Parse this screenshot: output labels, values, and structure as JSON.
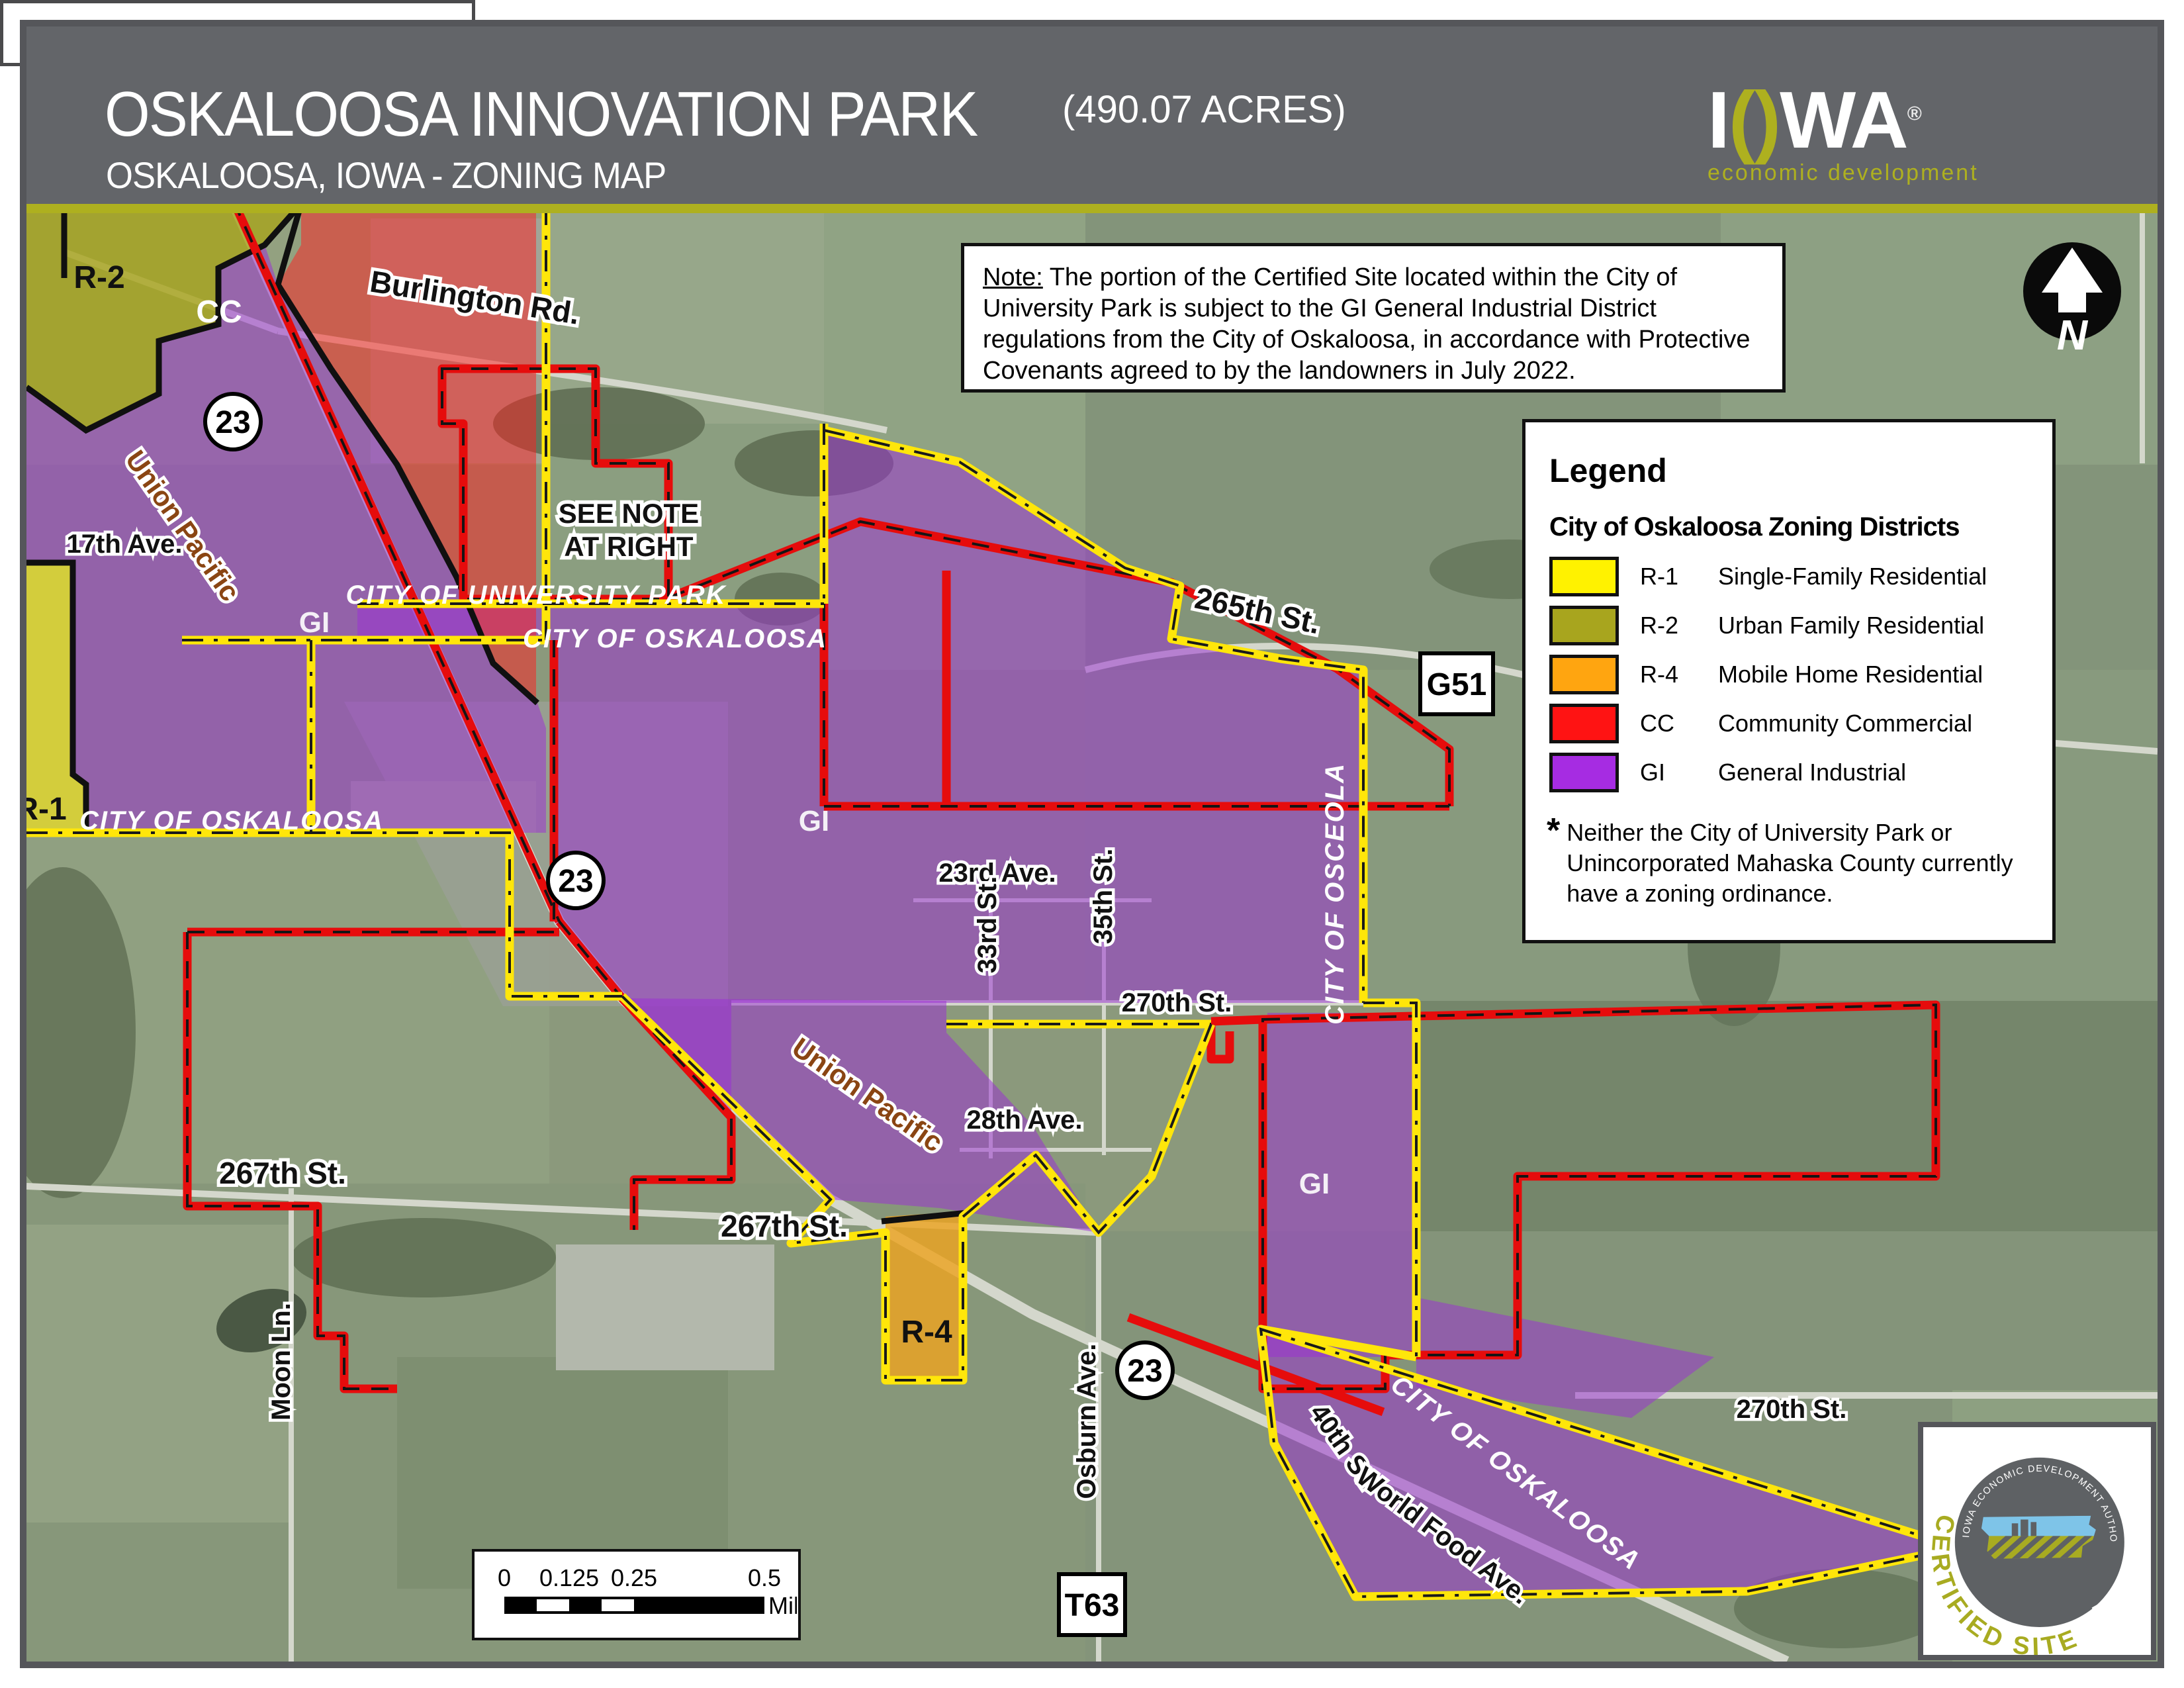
{
  "header": {
    "title": "OSKALOOSA INNOVATION PARK",
    "acres": "(490.07 ACRES)",
    "subtitle": "OSKALOOSA, IOWA - ZONING MAP",
    "logo": {
      "i": "I",
      "o": "()",
      "wa": "WA",
      "reg": "®",
      "tagline": "economic development"
    }
  },
  "note": {
    "label": "Note:",
    "body": " The portion of the Certified Site located within the City of University Park is subject to the GI General Industrial District regulations from the City of Oskaloosa, in accordance with Protective Covenants agreed to by the landowners in July 2022."
  },
  "legend": {
    "title": "Legend",
    "subtitle": "City of Oskaloosa Zoning Districts",
    "items": [
      {
        "code": "R-1",
        "label": "Single-Family Residential",
        "color": "#fff200"
      },
      {
        "code": "R-2",
        "label": "Urban Family Residential",
        "color": "#a8a51e"
      },
      {
        "code": "R-4",
        "label": "Mobile Home Residential",
        "color": "#ffa510"
      },
      {
        "code": "CC",
        "label": "Community Commercial",
        "color": "#ff1313"
      },
      {
        "code": "GI",
        "label": "General Industrial",
        "color": "#a62ce2"
      }
    ],
    "footnote_star": "*",
    "footnote_line1": "Neither the City of University Park or",
    "footnote_line2": "Unincorporated Mahaska County currently",
    "footnote_line3": "have a zoning ordinance."
  },
  "map": {
    "north": "N",
    "shields": {
      "hwy23": "23",
      "g51": "G51",
      "t63": "T63"
    },
    "labels": [
      {
        "text": "Burlington Rd."
      },
      {
        "text": "R-2"
      },
      {
        "text": "CC"
      },
      {
        "text": "Union Pacific"
      },
      {
        "text": "17th Ave."
      },
      {
        "text": "GI"
      },
      {
        "text": "R-1"
      },
      {
        "text": "CITY OF OSKALOOSA"
      },
      {
        "text": "SEE NOTE"
      },
      {
        "text": "AT RIGHT"
      },
      {
        "text": "CITY OF UNIVERSITY PARK"
      },
      {
        "text": "CITY OF OSKALOOSA"
      },
      {
        "text": "265th St."
      },
      {
        "text": "CITY OF OSCEOLA"
      },
      {
        "text": "GI"
      },
      {
        "text": "23rd Ave."
      },
      {
        "text": "33rd St."
      },
      {
        "text": "35th St."
      },
      {
        "text": "270th St."
      },
      {
        "text": "Union Pacific"
      },
      {
        "text": "28th Ave."
      },
      {
        "text": "267th St."
      },
      {
        "text": "267th St."
      },
      {
        "text": "Moon Ln."
      },
      {
        "text": "R-4"
      },
      {
        "text": "Osburn Ave."
      },
      {
        "text": "GI"
      },
      {
        "text": "40th St."
      },
      {
        "text": "World Food Ave."
      },
      {
        "text": "CITY OF OSKALOOSA"
      },
      {
        "text": "270th St."
      }
    ]
  },
  "scalebar": {
    "t0": "0",
    "t1": "0.125",
    "t2": "0.25",
    "t3": "0.5",
    "unit": "Miles"
  },
  "footer": {
    "prepared": "Map Prepared: February 2023"
  },
  "cert": {
    "arc": "IOWA ECONOMIC DEVELOPMENT AUTHORITY",
    "title": "CERTIFIED SITE"
  }
}
